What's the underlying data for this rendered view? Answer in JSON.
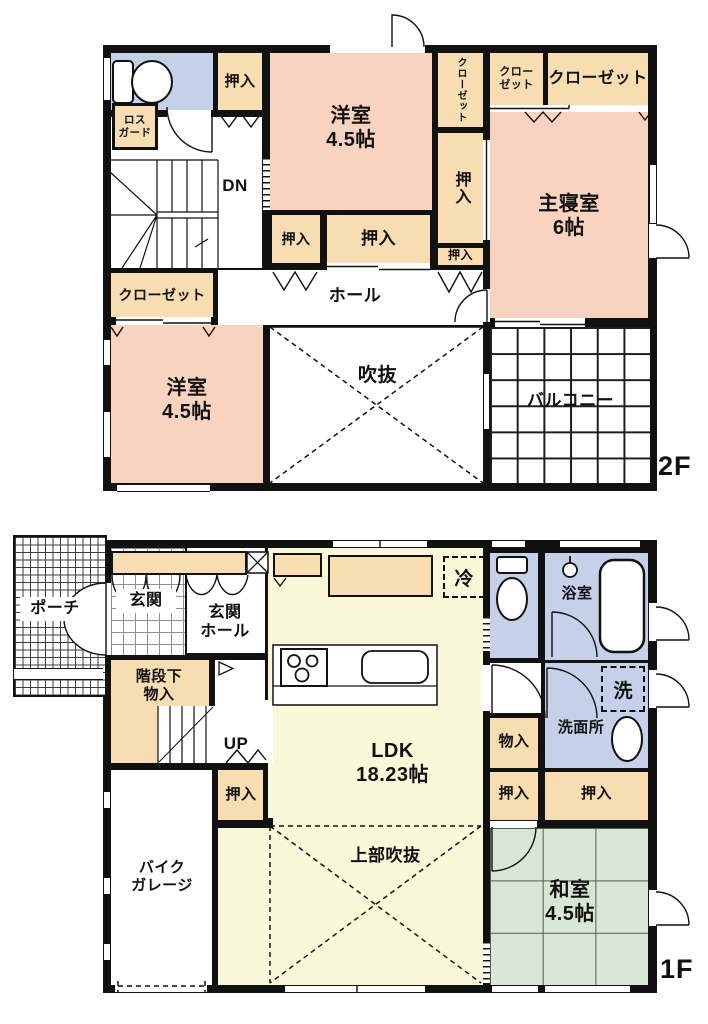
{
  "palette": {
    "wall": "#111111",
    "western_room_pink": "#f8d3bf",
    "storage_orange": "#f8dcb2",
    "wet_area_blue": "#c5d1e8",
    "ldk_yellow": "#fbf7d9",
    "tatami_green": "#d8e7d3"
  },
  "floor2": {
    "tag": "2F",
    "oshiire_top": "押入",
    "yoshitsu_top_name": "洋室",
    "yoshitsu_top_size": "4.5帖",
    "closet_vertical": "クローゼット",
    "closet_small_l1": "クロー",
    "closet_small_l2": "ゼット",
    "closet_wide": "クローゼット",
    "shinshitsu_name": "主寝室",
    "shinshitsu_size": "6帖",
    "losguard_l1": "ロス",
    "losguard_l2": "ガード",
    "dn": "DN",
    "oshiire_right_v": "押入",
    "oshiire_right_s": "押入",
    "oshiire_mid_s": "押入",
    "oshiire_mid_w": "押入",
    "hall": "ホール",
    "closet_bl": "クローゼット",
    "yoshitsu_b_name": "洋室",
    "yoshitsu_b_size": "4.5帖",
    "fukinuke": "吹抜",
    "balcony": "バルコニー"
  },
  "floor1": {
    "tag": "1F",
    "porch": "ポーチ",
    "genkan": "玄関",
    "genkan_hall_l1": "玄関",
    "genkan_hall_l2": "ホール",
    "kaidan_l1": "階段下",
    "kaidan_l2": "物入",
    "up": "UP",
    "oshiire_left": "押入",
    "garage_l1": "バイク",
    "garage_l2": "ガレージ",
    "ldk_name": "LDK",
    "ldk_size": "18.23帖",
    "rei": "冷",
    "jobu_fukinuke": "上部吹抜",
    "yokushitsu": "浴室",
    "sen": "洗",
    "senmenjo": "洗面所",
    "mononyu": "物入",
    "oshiire_r1": "押入",
    "oshiire_r2": "押入",
    "washitsu_name": "和室",
    "washitsu_size": "4.5帖"
  }
}
